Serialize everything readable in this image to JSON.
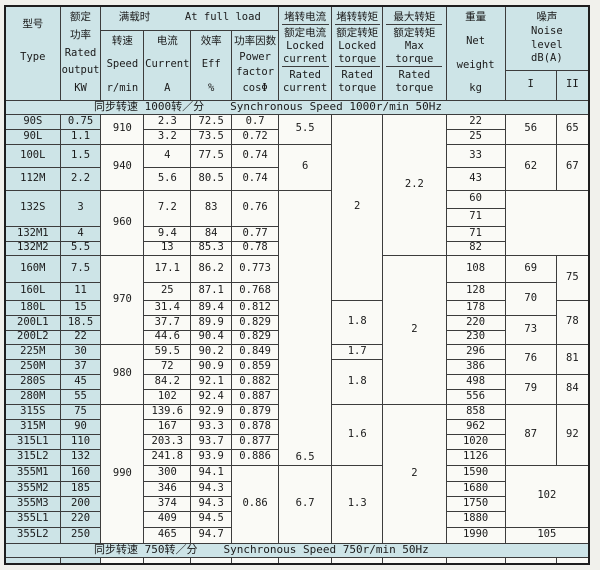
{
  "colors": {
    "tint": "#cde4e7",
    "paper": "#f1f1ec",
    "cell_bg": "#fafaf6",
    "line": "#3c3c3c",
    "line_strong": "#1e1e1e",
    "text": "#1b1b1b"
  },
  "header": {
    "type": {
      "zh": "型号",
      "en": "Type"
    },
    "rated": {
      "zh1": "额定",
      "zh2": "功率",
      "en1": "Rated",
      "en2": "output",
      "unit": "KW"
    },
    "full_load": {
      "zh": "满载时",
      "en": "At full load"
    },
    "speed": {
      "zh": "转速",
      "en": "Speed",
      "unit": "r/min"
    },
    "current": {
      "zh": "电流",
      "en": "Current",
      "unit": "A"
    },
    "eff": {
      "zh": "效率",
      "en": "Eff",
      "unit": "%"
    },
    "pf": {
      "zh": "功率因数",
      "en1": "Power",
      "en2": "factor",
      "unit": "cosΦ"
    },
    "locked_current": {
      "zh_num": "堵转电流",
      "zh_den": "额定电流",
      "en_num1": "Locked",
      "en_num2": "current",
      "en_den1": "Rated",
      "en_den2": "current"
    },
    "locked_torque": {
      "zh_num": "堵转转矩",
      "zh_den": "额定转矩",
      "en_num1": "Locked",
      "en_num2": "torque",
      "en_den1": "Rated",
      "en_den2": "torque"
    },
    "max_torque": {
      "zh_num": "最大转矩",
      "zh_den": "额定转矩",
      "en_num1": "Max",
      "en_num2": "torque",
      "en_den1": "Rated",
      "en_den2": "torque"
    },
    "weight": {
      "zh": "重量",
      "en1": "Net",
      "en2": "weight",
      "unit": "kg"
    },
    "noise": {
      "zh": "噪声",
      "en1": "Noise",
      "en2": "level",
      "unit": "dB(A)",
      "sub1": "I",
      "sub2": "II"
    }
  },
  "grid": {
    "rows": [
      {
        "band": {
          "zh": "同步转速 1000转／分",
          "en": "Synchronous Speed 1000r/min  50Hz"
        }
      },
      [
        {
          "t": "90S",
          "tint": true,
          "n": "type-cell"
        },
        {
          "t": "0.75",
          "tint": true,
          "n": "rated-kw-cell"
        },
        {
          "t": "910",
          "rs": 2
        },
        {
          "t": "2.3"
        },
        {
          "t": "72.5"
        },
        {
          "t": "0.7"
        },
        {
          "t": "5.5",
          "rs": 2
        },
        {
          "t": "2",
          "rs": 10
        },
        {
          "t": "2.2",
          "rs": 8
        },
        {
          "t": "22"
        },
        {
          "t": "56",
          "rs": 2
        },
        {
          "t": "65",
          "rs": 2
        }
      ],
      [
        {
          "t": "90L",
          "tint": true,
          "n": "type-cell"
        },
        {
          "t": "1.1",
          "tint": true,
          "n": "rated-kw-cell"
        },
        {
          "t": "3.2"
        },
        {
          "t": "73.5"
        },
        {
          "t": "0.72"
        },
        {
          "t": "25"
        }
      ],
      [
        {
          "t": "100L",
          "tint": true,
          "n": "type-cell"
        },
        {
          "t": "1.5",
          "tint": true,
          "n": "rated-kw-cell"
        },
        {
          "t": "940",
          "rs": 2
        },
        {
          "t": "4"
        },
        {
          "t": "77.5"
        },
        {
          "t": "0.74"
        },
        {
          "t": "6",
          "rs": 2
        },
        {
          "t": "33"
        },
        {
          "t": "62",
          "rs": 2
        },
        {
          "t": "67",
          "rs": 2
        }
      ],
      [
        {
          "t": "112M",
          "tint": true,
          "n": "type-cell"
        },
        {
          "t": "2.2",
          "tint": true,
          "n": "rated-kw-cell"
        },
        {
          "t": "5.6"
        },
        {
          "t": "80.5"
        },
        {
          "t": "0.74"
        },
        {
          "t": "43"
        }
      ],
      [
        {
          "t": "132S",
          "tint": true,
          "rs": 2,
          "n": "type-cell"
        },
        {
          "t": "3",
          "tint": true,
          "rs": 2,
          "n": "rated-kw-cell"
        },
        {
          "t": "960",
          "rs": 4
        },
        {
          "t": "7.2",
          "rs": 2
        },
        {
          "t": "83",
          "rs": 2
        },
        {
          "t": "0.76",
          "rs": 2
        },
        {
          "t": "6.5",
          "rs": 17,
          "va": "bottom"
        },
        {
          "t": "60"
        }
      ],
      [
        {
          "t": "71"
        }
      ],
      [
        {
          "t": "132M1",
          "tint": true,
          "n": "type-cell"
        },
        {
          "t": "4",
          "tint": true,
          "n": "rated-kw-cell"
        },
        {
          "t": "9.4"
        },
        {
          "t": "84"
        },
        {
          "t": "0.77"
        },
        {
          "t": "71"
        }
      ],
      [
        {
          "t": "132M2",
          "tint": true,
          "n": "type-cell"
        },
        {
          "t": "5.5",
          "tint": true,
          "n": "rated-kw-cell"
        },
        {
          "t": "13"
        },
        {
          "t": "85.3"
        },
        {
          "t": "0.78"
        },
        {
          "t": "82"
        }
      ],
      [
        {
          "t": "160M",
          "tint": true,
          "n": "type-cell"
        },
        {
          "t": "7.5",
          "tint": true,
          "n": "rated-kw-cell"
        },
        {
          "t": "970",
          "rs": 5
        },
        {
          "t": "17.1"
        },
        {
          "t": "86.2"
        },
        {
          "t": "0.773"
        },
        {
          "t": "2",
          "rs": 9
        },
        {
          "t": "108"
        },
        {
          "t": "69"
        },
        {
          "t": "75",
          "rs": 2
        }
      ],
      [
        {
          "t": "160L",
          "tint": true,
          "n": "type-cell"
        },
        {
          "t": "11",
          "tint": true,
          "n": "rated-kw-cell"
        },
        {
          "t": "25"
        },
        {
          "t": "87.1"
        },
        {
          "t": "0.768"
        },
        {
          "t": "128"
        },
        {
          "t": "70",
          "rs": 2
        }
      ],
      [
        {
          "t": "180L",
          "tint": true,
          "n": "type-cell"
        },
        {
          "t": "15",
          "tint": true,
          "n": "rated-kw-cell"
        },
        {
          "t": "31.4"
        },
        {
          "t": "89.4"
        },
        {
          "t": "0.812"
        },
        {
          "t": "1.8",
          "rs": 3
        },
        {
          "t": "178"
        },
        {
          "t": "78",
          "rs": 3
        }
      ],
      [
        {
          "t": "200L1",
          "tint": true,
          "n": "type-cell"
        },
        {
          "t": "18.5",
          "tint": true,
          "n": "rated-kw-cell"
        },
        {
          "t": "37.7"
        },
        {
          "t": "89.9"
        },
        {
          "t": "0.829"
        },
        {
          "t": "220"
        },
        {
          "t": "73",
          "rs": 2
        }
      ],
      [
        {
          "t": "200L2",
          "tint": true,
          "n": "type-cell"
        },
        {
          "t": "22",
          "tint": true,
          "n": "rated-kw-cell"
        },
        {
          "t": "44.6"
        },
        {
          "t": "90.4"
        },
        {
          "t": "0.829"
        },
        {
          "t": "230"
        }
      ],
      [
        {
          "t": "225M",
          "tint": true,
          "n": "type-cell"
        },
        {
          "t": "30",
          "tint": true,
          "n": "rated-kw-cell"
        },
        {
          "t": "980",
          "rs": 4
        },
        {
          "t": "59.5"
        },
        {
          "t": "90.2"
        },
        {
          "t": "0.849"
        },
        {
          "t": "1.7"
        },
        {
          "t": "296"
        },
        {
          "t": "76",
          "rs": 2
        },
        {
          "t": "81",
          "rs": 2
        }
      ],
      [
        {
          "t": "250M",
          "tint": true,
          "n": "type-cell"
        },
        {
          "t": "37",
          "tint": true,
          "n": "rated-kw-cell"
        },
        {
          "t": "72"
        },
        {
          "t": "90.9"
        },
        {
          "t": "0.859"
        },
        {
          "t": "1.8",
          "rs": 3
        },
        {
          "t": "386"
        }
      ],
      [
        {
          "t": "280S",
          "tint": true,
          "n": "type-cell"
        },
        {
          "t": "45",
          "tint": true,
          "n": "rated-kw-cell"
        },
        {
          "t": "84.2"
        },
        {
          "t": "92.1"
        },
        {
          "t": "0.882"
        },
        {
          "t": "498"
        },
        {
          "t": "79",
          "rs": 2
        },
        {
          "t": "84",
          "rs": 2
        }
      ],
      [
        {
          "t": "280M",
          "tint": true,
          "n": "type-cell"
        },
        {
          "t": "55",
          "tint": true,
          "n": "rated-kw-cell"
        },
        {
          "t": "102"
        },
        {
          "t": "92.4"
        },
        {
          "t": "0.887"
        },
        {
          "t": "556"
        }
      ],
      [
        {
          "t": "315S",
          "tint": true,
          "n": "type-cell"
        },
        {
          "t": "75",
          "tint": true,
          "n": "rated-kw-cell"
        },
        {
          "t": "990",
          "rs": 9
        },
        {
          "t": "139.6"
        },
        {
          "t": "92.9"
        },
        {
          "t": "0.879"
        },
        {
          "t": "1.6",
          "rs": 4
        },
        {
          "t": "2",
          "rs": 9
        },
        {
          "t": "858"
        },
        {
          "t": "87",
          "rs": 4
        },
        {
          "t": "92",
          "rs": 4
        }
      ],
      [
        {
          "t": "315M",
          "tint": true,
          "n": "type-cell"
        },
        {
          "t": "90",
          "tint": true,
          "n": "rated-kw-cell"
        },
        {
          "t": "167"
        },
        {
          "t": "93.3"
        },
        {
          "t": "0.878"
        },
        {
          "t": "962"
        }
      ],
      [
        {
          "t": "315L1",
          "tint": true,
          "n": "type-cell"
        },
        {
          "t": "110",
          "tint": true,
          "n": "rated-kw-cell"
        },
        {
          "t": "203.3"
        },
        {
          "t": "93.7"
        },
        {
          "t": "0.877"
        },
        {
          "t": "1020"
        }
      ],
      [
        {
          "t": "315L2",
          "tint": true,
          "n": "type-cell"
        },
        {
          "t": "132",
          "tint": true,
          "n": "rated-kw-cell"
        },
        {
          "t": "241.8"
        },
        {
          "t": "93.9"
        },
        {
          "t": "0.886"
        },
        {
          "t": "1126"
        }
      ],
      [
        {
          "t": "355M1",
          "tint": true,
          "n": "type-cell"
        },
        {
          "t": "160",
          "tint": true,
          "n": "rated-kw-cell"
        },
        {
          "t": "300"
        },
        {
          "t": "94.1"
        },
        {
          "t": "0.86",
          "rs": 5
        },
        {
          "t": "6.7",
          "rs": 5
        },
        {
          "t": "1.3",
          "rs": 5
        },
        {
          "t": "1590"
        },
        {
          "t": "102",
          "rs": 4,
          "cs": 2
        }
      ],
      [
        {
          "t": "355M2",
          "tint": true,
          "n": "type-cell"
        },
        {
          "t": "185",
          "tint": true,
          "n": "rated-kw-cell"
        },
        {
          "t": "346"
        },
        {
          "t": "94.3"
        },
        {
          "t": "1680"
        }
      ],
      [
        {
          "t": "355M3",
          "tint": true,
          "n": "type-cell"
        },
        {
          "t": "200",
          "tint": true,
          "n": "rated-kw-cell"
        },
        {
          "t": "374"
        },
        {
          "t": "94.3"
        },
        {
          "t": "1750"
        }
      ],
      [
        {
          "t": "355L1",
          "tint": true,
          "n": "type-cell"
        },
        {
          "t": "220",
          "tint": true,
          "n": "rated-kw-cell"
        },
        {
          "t": "409"
        },
        {
          "t": "94.5"
        },
        {
          "t": "1880"
        }
      ],
      [
        {
          "t": "355L2",
          "tint": true,
          "n": "type-cell"
        },
        {
          "t": "250",
          "tint": true,
          "n": "rated-kw-cell"
        },
        {
          "t": "465"
        },
        {
          "t": "94.7"
        },
        {
          "t": "1990"
        },
        {
          "t": "105",
          "cs": 2
        }
      ],
      {
        "band": {
          "zh": "同步转速 750转／分",
          "en": "Synchronous Speed 750r/min  50Hz"
        }
      },
      {
        "stub": true
      }
    ]
  }
}
